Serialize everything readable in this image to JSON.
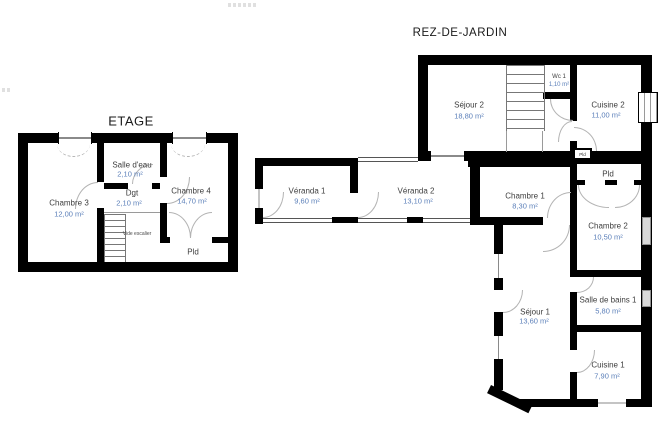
{
  "etage": {
    "title": "ETAGE",
    "rooms": {
      "chambre3": {
        "name": "Chambre 3",
        "area": "12,00 m²"
      },
      "salle_deau": {
        "name": "Salle d'eau",
        "area": "2,10 m²"
      },
      "dgt": {
        "name": "Dgt",
        "area": "2,10 m²"
      },
      "chambre4": {
        "name": "Chambre 4",
        "area": "14,70 m²"
      },
      "vide_escalier": {
        "name": "Vide escalier"
      },
      "pld": {
        "name": "Pld"
      }
    }
  },
  "rez_de_jardin": {
    "title": "REZ-DE-JARDIN",
    "rooms": {
      "sejour2": {
        "name": "Séjour 2",
        "area": "18,80 m²"
      },
      "wc1": {
        "name": "Wc 1",
        "area": "1,10 m²"
      },
      "cuisine2": {
        "name": "Cuisine 2",
        "area": "11,00 m²"
      },
      "pld_placard": {
        "name": "Pld"
      },
      "veranda1": {
        "name": "Véranda 1",
        "area": "9,60 m²"
      },
      "veranda2": {
        "name": "Véranda 2",
        "area": "13,10 m²"
      },
      "chambre1": {
        "name": "Chambre 1",
        "area": "8,30 m²"
      },
      "pld": {
        "name": "Pld"
      },
      "chambre2": {
        "name": "Chambre 2",
        "area": "10,50 m²"
      },
      "sejour1": {
        "name": "Séjour 1",
        "area": "13,60 m²"
      },
      "salle_de_bains1": {
        "name": "Salle de bains 1",
        "area": "5,80 m²"
      },
      "cuisine1": {
        "name": "Cuisine 1",
        "area": "7,90 m²"
      }
    }
  },
  "colors": {
    "wall": "#000000",
    "room_name": "#3d3d3d",
    "room_area": "#5b7fb9",
    "door_arc": "#b3b3b3",
    "background": "#ffffff"
  }
}
